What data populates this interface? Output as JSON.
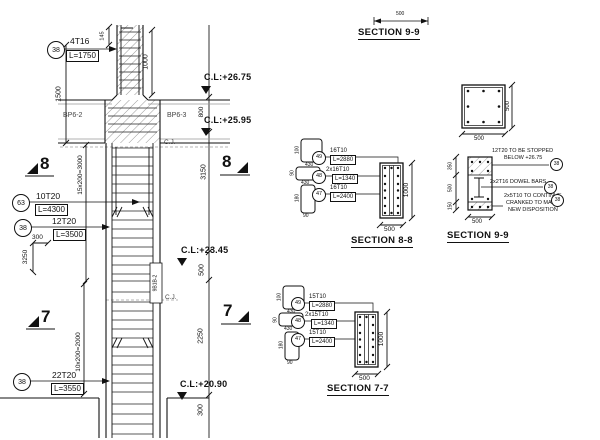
{
  "elevation": {
    "levels": {
      "a": "C.L:+26.75",
      "b": "C.L:+25.95",
      "c": "C.L:+23.45",
      "d": "C.L:+20.90"
    },
    "callouts": {
      "c1": {
        "mark": "38",
        "bars": "4T16",
        "len": "L=1750"
      },
      "c2": {
        "mark": "63",
        "bars": "10T20",
        "len": "L=4300"
      },
      "c3": {
        "mark": "38",
        "bars": "12T20",
        "len": "L=3500"
      },
      "c4": {
        "mark": "38",
        "bars": "22T20",
        "len": "L=3550"
      }
    },
    "dims": {
      "h1500": "1500",
      "h145": "145",
      "h1000": "1000",
      "beam_depth": "800",
      "h3150": "3150",
      "h500": "500",
      "h2250": "2250",
      "h300": "300",
      "bend_w": "300",
      "bend_h": "3250",
      "zone8": "15x200=3000",
      "zone7": "10x200=2000"
    },
    "beams": {
      "left": "BP6-2",
      "right": "BP6-3"
    },
    "cj": "C.J.",
    "splice_tag": "9B1B-2",
    "marker8": "8",
    "marker7": "7"
  },
  "sections": {
    "top": {
      "title": "SECTION 9-9",
      "dim": "500"
    },
    "s88": {
      "title": "SECTION 8-8",
      "dim_w": "500",
      "dim_h": "1000",
      "links": [
        {
          "mark": "49",
          "b1": "16T10",
          "b2": "L=2880"
        },
        {
          "mark": "48",
          "b1": "2x16T10",
          "b2": "L=1340"
        },
        {
          "mark": "47",
          "b1": "16T10",
          "b2": "L=2400"
        }
      ],
      "shape_dims": [
        {
          "w": "430",
          "h": "100"
        },
        {
          "w": "430",
          "h": "90"
        },
        {
          "w": "90",
          "h": "180"
        }
      ]
    },
    "s77": {
      "title": "SECTION 7-7",
      "dim_w": "500",
      "dim_h": "1000",
      "links": [
        {
          "mark": "49",
          "b1": "15T10",
          "b2": "L=2880"
        },
        {
          "mark": "48",
          "b1": "2x15T10",
          "b2": "L=1340"
        },
        {
          "mark": "47",
          "b1": "15T10",
          "b2": "L=2400"
        }
      ],
      "shape_dims": [
        {
          "w": "430",
          "h": "100"
        },
        {
          "w": "430",
          "h": "90"
        },
        {
          "w": "90",
          "h": "180"
        }
      ]
    },
    "s99": {
      "title": "SECTION 9-9",
      "square": {
        "dim_w": "500",
        "dim_h": "500"
      },
      "stack": {
        "d1": "350",
        "d2": "500",
        "d3": "150",
        "dim_w": "500"
      },
      "notes": [
        {
          "l1": "12T20 TO BE STOPPED",
          "l2": "BELOW +26.75",
          "mark": "38"
        },
        {
          "l1": "2x2T16 DOWEL BARS",
          "mark": "38"
        },
        {
          "l1": "2x5T10 TO CONTINUE",
          "l2": "CRANKED TO MATCH",
          "l3": "NEW DISPOSITION",
          "mark": "38"
        }
      ]
    }
  }
}
